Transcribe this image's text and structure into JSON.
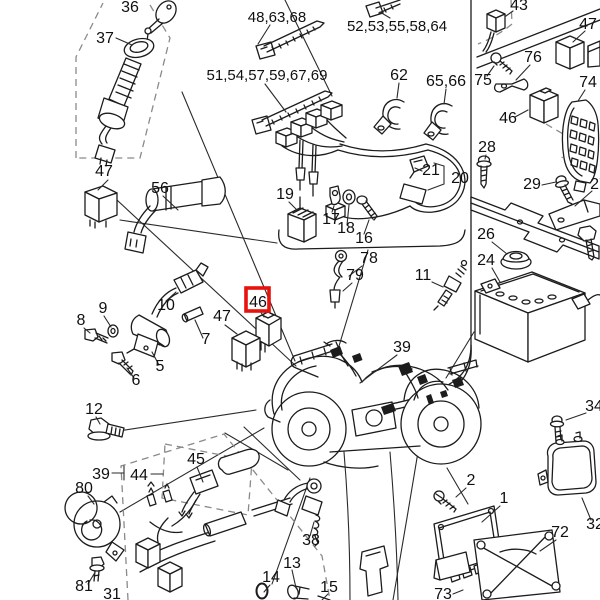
{
  "canvas": {
    "width": 600,
    "height": 600,
    "background": "#ffffff"
  },
  "figure": {
    "kind": "exploded-parts-diagram",
    "line_color": "#1c1c1c",
    "highlight_color": "#e8120c"
  },
  "highlight": {
    "part": "46",
    "x": 246,
    "y": 288,
    "width": 23,
    "height": 23,
    "color": "#e8120c"
  },
  "callouts": [
    {
      "text": "36",
      "x": 130,
      "y": 12
    },
    {
      "text": "37",
      "x": 105,
      "y": 43
    },
    {
      "text": "47",
      "x": 104,
      "y": 176
    },
    {
      "text": "56",
      "x": 160,
      "y": 193
    },
    {
      "text": "48,63,68",
      "x": 277,
      "y": 22
    },
    {
      "text": "51,54,57,59,67,69",
      "x": 267,
      "y": 80
    },
    {
      "text": "52,53,55,58,64",
      "x": 397,
      "y": 31
    },
    {
      "text": "62",
      "x": 399,
      "y": 80
    },
    {
      "text": "65,66",
      "x": 446,
      "y": 86
    },
    {
      "text": "43",
      "x": 519,
      "y": 10
    },
    {
      "text": "47",
      "x": 588,
      "y": 29
    },
    {
      "text": "76",
      "x": 533,
      "y": 62
    },
    {
      "text": "75",
      "x": 483,
      "y": 85
    },
    {
      "text": "74",
      "x": 588,
      "y": 87
    },
    {
      "text": "46",
      "x": 508,
      "y": 123
    },
    {
      "text": "28",
      "x": 487,
      "y": 152
    },
    {
      "text": "29",
      "x": 532,
      "y": 189
    },
    {
      "text": "27",
      "x": 599,
      "y": 189
    },
    {
      "text": "26",
      "x": 486,
      "y": 239
    },
    {
      "text": "24",
      "x": 486,
      "y": 265
    },
    {
      "text": "19",
      "x": 285,
      "y": 199
    },
    {
      "text": "17",
      "x": 331,
      "y": 224
    },
    {
      "text": "18",
      "x": 346,
      "y": 233
    },
    {
      "text": "16",
      "x": 364,
      "y": 243
    },
    {
      "text": "21",
      "x": 431,
      "y": 175
    },
    {
      "text": "20",
      "x": 460,
      "y": 183
    },
    {
      "text": "78",
      "x": 369,
      "y": 263
    },
    {
      "text": "79",
      "x": 355,
      "y": 280
    },
    {
      "text": "11",
      "x": 423,
      "y": 280
    },
    {
      "text": "8",
      "x": 81,
      "y": 325
    },
    {
      "text": "9",
      "x": 103,
      "y": 313
    },
    {
      "text": "10",
      "x": 166,
      "y": 310
    },
    {
      "text": "7",
      "x": 206,
      "y": 344
    },
    {
      "text": "5",
      "x": 160,
      "y": 371
    },
    {
      "text": "6",
      "x": 136,
      "y": 385
    },
    {
      "text": "47",
      "x": 222,
      "y": 321
    },
    {
      "text": "46",
      "x": 258,
      "y": 307,
      "highlighted": true
    },
    {
      "text": "39",
      "x": 402,
      "y": 352
    },
    {
      "text": "12",
      "x": 94,
      "y": 414
    },
    {
      "text": "39",
      "x": 101,
      "y": 479
    },
    {
      "text": "44",
      "x": 139,
      "y": 480
    },
    {
      "text": "80",
      "x": 84,
      "y": 493
    },
    {
      "text": "45",
      "x": 196,
      "y": 464
    },
    {
      "text": "81",
      "x": 84,
      "y": 591
    },
    {
      "text": "31",
      "x": 112,
      "y": 599
    },
    {
      "text": "38",
      "x": 311,
      "y": 545
    },
    {
      "text": "13",
      "x": 292,
      "y": 568
    },
    {
      "text": "14",
      "x": 271,
      "y": 582
    },
    {
      "text": "15",
      "x": 329,
      "y": 592
    },
    {
      "text": "73",
      "x": 443,
      "y": 599
    },
    {
      "text": "34",
      "x": 594,
      "y": 411
    },
    {
      "text": "32",
      "x": 595,
      "y": 529
    },
    {
      "text": "2",
      "x": 471,
      "y": 485
    },
    {
      "text": "1",
      "x": 504,
      "y": 503
    },
    {
      "text": "72",
      "x": 560,
      "y": 537
    }
  ]
}
